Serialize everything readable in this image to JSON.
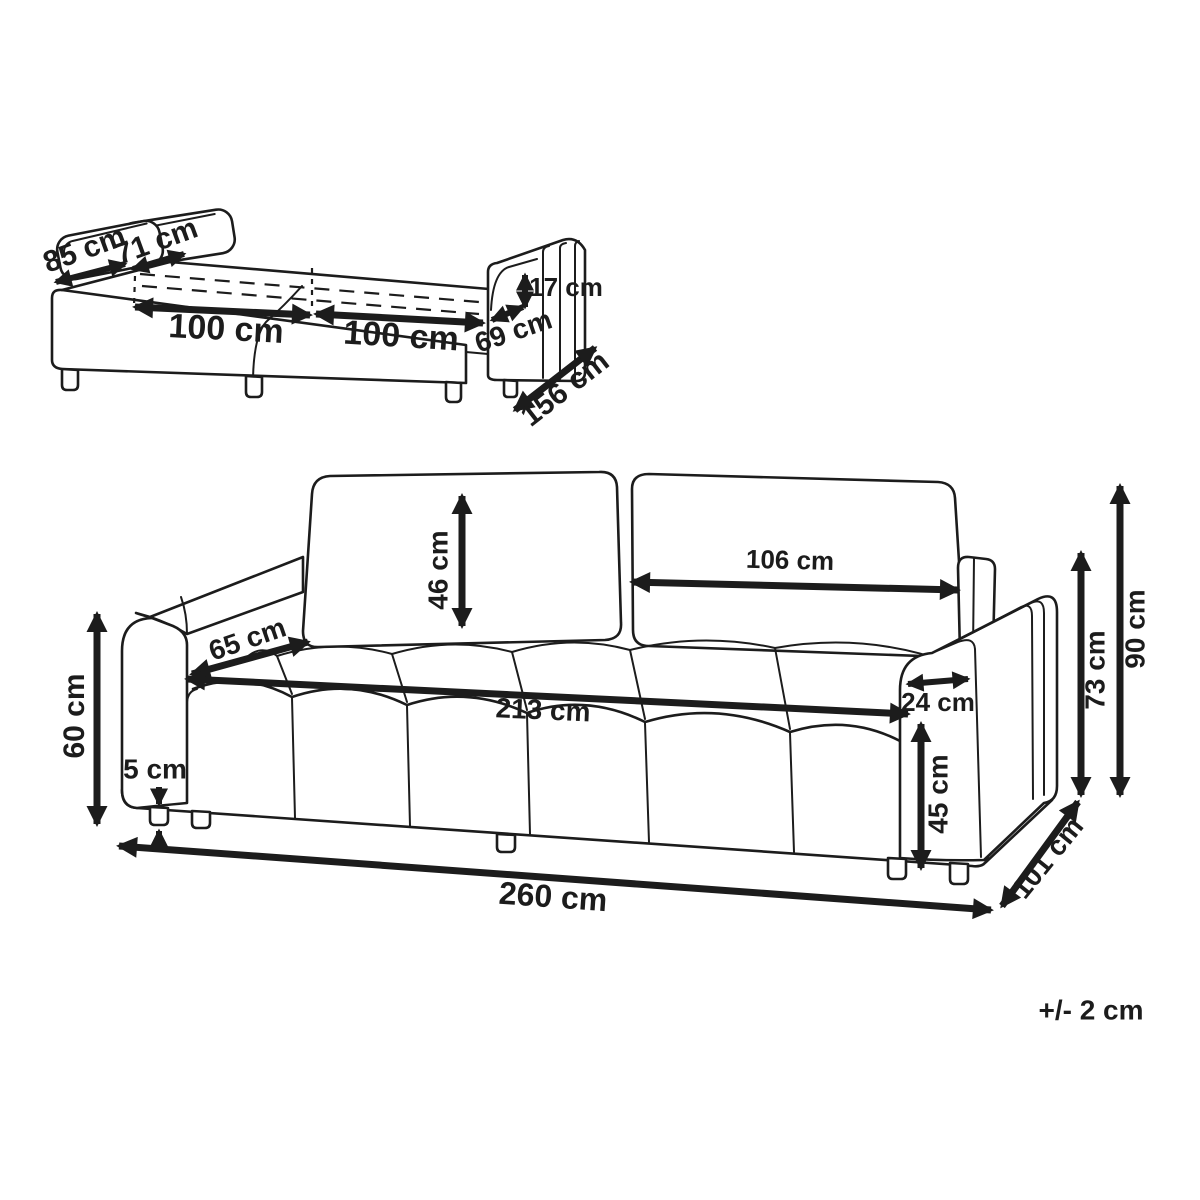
{
  "page": {
    "background": "#ffffff",
    "line_color": "#1c1c1c",
    "unit": "cm"
  },
  "top_view": {
    "name": "sofa-bed unfolded perspective view",
    "dimensions": [
      {
        "id": "back-cushion-left-width",
        "label": "85 cm"
      },
      {
        "id": "back-cushion-right-width",
        "label": "71 cm"
      },
      {
        "id": "bed-half-left-length",
        "label": "100 cm"
      },
      {
        "id": "bed-half-right-length",
        "label": "100 cm"
      },
      {
        "id": "armrest-above-bed-height",
        "label": "17 cm"
      },
      {
        "id": "armrest-depth",
        "label": "69 cm"
      },
      {
        "id": "bed-total-depth",
        "label": "156 cm"
      }
    ]
  },
  "main_view": {
    "name": "sofa front perspective view",
    "dimensions": [
      {
        "id": "backrest-cushion-height",
        "label": "46 cm"
      },
      {
        "id": "backrest-cushion-width",
        "label": "106 cm"
      },
      {
        "id": "seat-depth",
        "label": "65 cm"
      },
      {
        "id": "armrest-height",
        "label": "60 cm"
      },
      {
        "id": "leg-height",
        "label": "5 cm"
      },
      {
        "id": "seat-width",
        "label": "213 cm"
      },
      {
        "id": "armrest-width",
        "label": "24 cm"
      },
      {
        "id": "seat-height",
        "label": "45 cm"
      },
      {
        "id": "back-height",
        "label": "73 cm"
      },
      {
        "id": "total-height",
        "label": "90 cm"
      },
      {
        "id": "total-depth",
        "label": "101 cm"
      },
      {
        "id": "total-width",
        "label": "260 cm"
      }
    ]
  },
  "footnote": {
    "tolerance": "+/- 2 cm"
  }
}
